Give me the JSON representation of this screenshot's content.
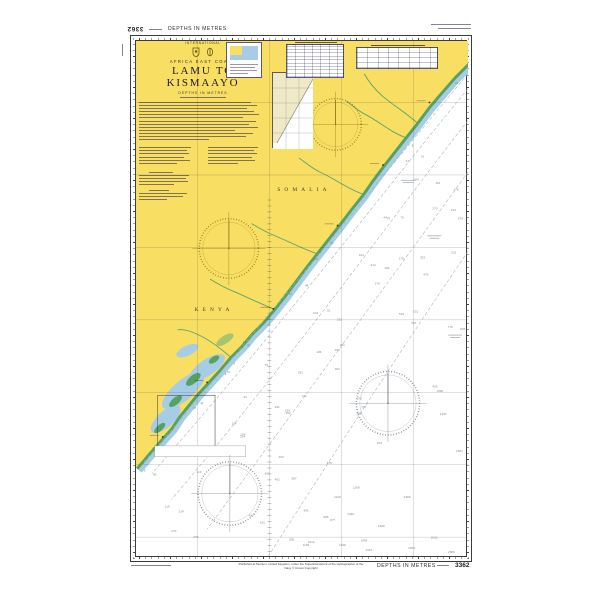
{
  "chart": {
    "number": "3362",
    "title": "LAMU TO KISMAAYO",
    "region": "AFRICA EAST COAST",
    "international": "INTERNATIONAL",
    "depths_note": "DEPTHS IN METRES"
  },
  "margins": {
    "top_left_number_inverted": "3362",
    "top_depths": "DEPTHS IN METRES",
    "bottom_depths": "DEPTHS IN METRES",
    "bottom_number": "3362",
    "publication_line1": "Published at Taunton, United Kingdom, under the Superintendence of the Hydrographer of the Navy",
    "publication_line2": "© Crown Copyright"
  },
  "map_labels": {
    "somalia": "SOMALIA",
    "kenya": "KENYA"
  },
  "legend": {
    "tidal_table_large": "tidal-streams-table",
    "tidal_table_small": "tidal-levels-table",
    "satellite_box": "satellite-imagery-index",
    "source_diagram": "source-data-diagram"
  },
  "colors": {
    "land_yellow": "#F8DE63",
    "intertidal_green": "#57A263",
    "shallow_blue": "#A6CCE8",
    "sea_white": "#FFFFFF",
    "rose_land": "#877318",
    "rose_sea": "#6E747A",
    "sounding_grey": "#818C95",
    "frame": "#3C3C3C"
  },
  "soundings": {
    "values": [
      9,
      13,
      18,
      24,
      31,
      37,
      44,
      55,
      66,
      79,
      91,
      104,
      119,
      134,
      146,
      161,
      178,
      196,
      214,
      232,
      251,
      270,
      291,
      311,
      333,
      356,
      379,
      402,
      427,
      452,
      478,
      504,
      531,
      558,
      587,
      615,
      645,
      675,
      706,
      737,
      770,
      802,
      836,
      870,
      905,
      941,
      977,
      1014,
      1052,
      1090,
      1129,
      1169,
      1210,
      1251,
      1293,
      1336,
      1379,
      1424,
      1469,
      1514,
      1561,
      1608,
      1656,
      1705,
      1754,
      1804,
      1855,
      1907,
      1959,
      2012,
      2066,
      2121,
      2176,
      2233,
      2290,
      2347,
      2406,
      2465,
      2525,
      2586
    ]
  },
  "compass_roses": [
    {
      "location": "somalia-land",
      "cx": 202,
      "cy": 84,
      "r": 26
    },
    {
      "location": "kenya-land",
      "cx": 94,
      "cy": 209,
      "r": 30
    },
    {
      "location": "sea-mid",
      "cx": 255,
      "cy": 365,
      "r": 32
    },
    {
      "location": "sea-south",
      "cx": 95,
      "cy": 456,
      "r": 32
    }
  ]
}
